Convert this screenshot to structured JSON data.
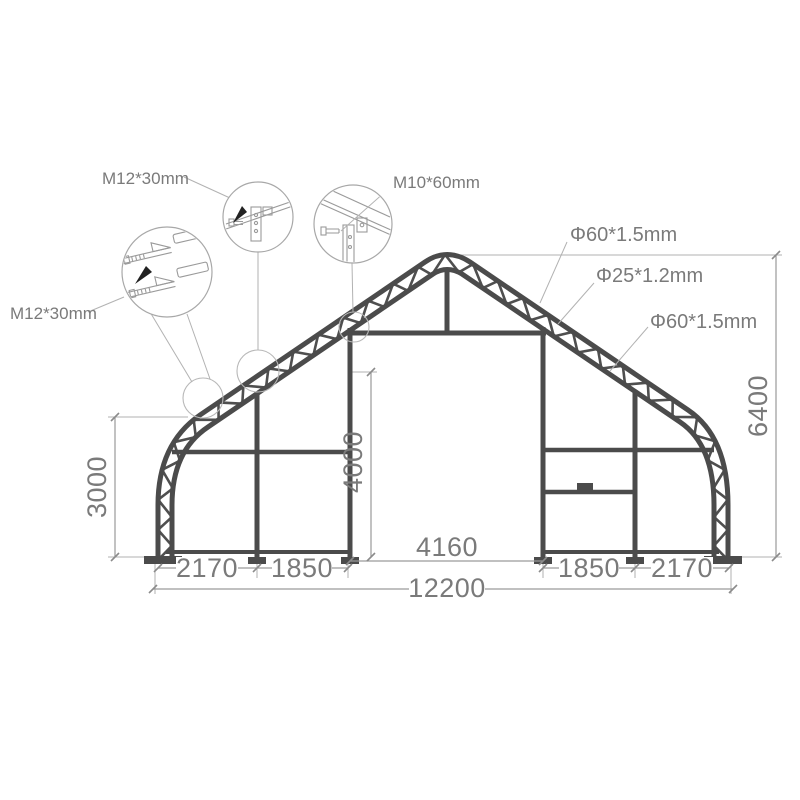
{
  "drawing": {
    "type": "storage-shelter-frame-elevation",
    "dimensions": {
      "left_bay": "2170",
      "left_mid_bay": "1850",
      "door_width": "4160",
      "right_mid_bay": "1850",
      "right_bay": "2170",
      "total_width": "12200",
      "side_height": "3000",
      "door_height": "4000",
      "ridge_height": "6400"
    },
    "callouts": {
      "splice_bolt": "M12*30mm",
      "girt_bolt": "M12*30mm",
      "post_bolt": "M10*60mm",
      "outer_chord_tube": "Φ60*1.5mm",
      "web_tube": "Φ25*1.2mm",
      "inner_chord_tube": "Φ60*1.5mm"
    },
    "colors": {
      "frame": "#4b4b4b",
      "linework": "#9a9a9a",
      "text": "#7a7a7a",
      "background": "#ffffff"
    }
  }
}
